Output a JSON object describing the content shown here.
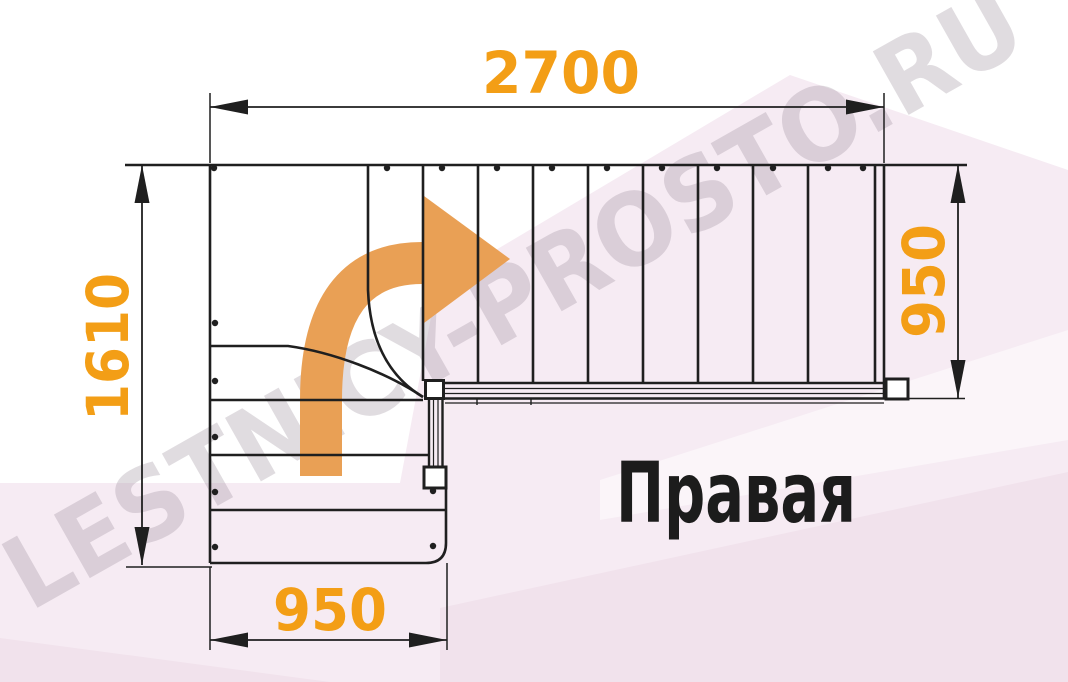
{
  "drawing": {
    "type_label": "Правая",
    "watermark": "LESTNICY-PROSTO.RU",
    "dimensions": {
      "top_width": "2700",
      "left_height": "1610",
      "right_height": "950",
      "bottom_width": "950"
    }
  },
  "colors": {
    "dimension_text": "#F39E16",
    "arrow": "#E9A055",
    "line": "#1F1F1F",
    "label_text": "#1C1C1C",
    "watermark": "#9B8F9B",
    "bg_pink": "#F6EBF3",
    "bg_pink_dark": "#F1E2EC"
  }
}
